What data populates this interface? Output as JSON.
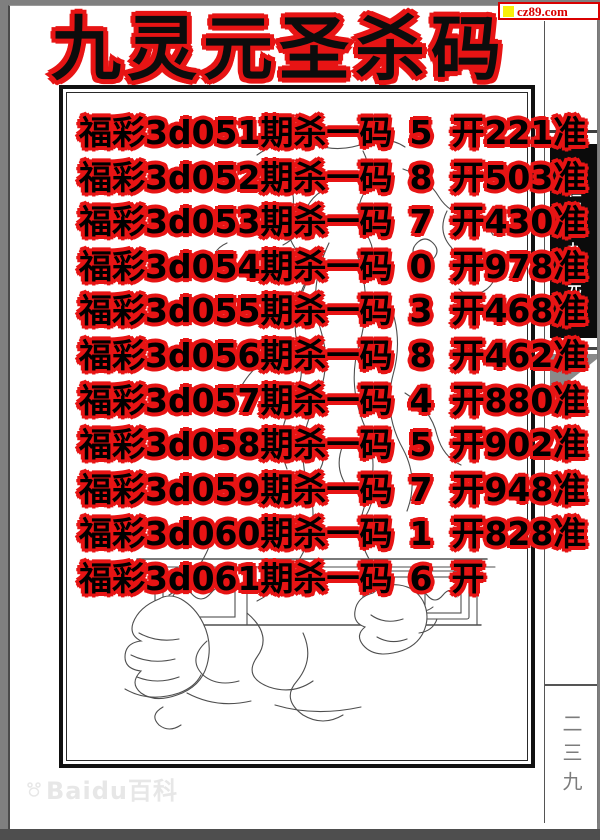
{
  "header": {
    "title": "九灵元圣杀码",
    "site": "cz89.com"
  },
  "spine": {
    "label": "盘桓洞·九灵元圣",
    "page_number": "二三九"
  },
  "footer": {
    "baidu_watermark": "Baidu百科"
  },
  "colors": {
    "outline_red": "#e71414",
    "badge_red": "#d90000",
    "badge_yellow": "#f8ef0a",
    "tab_black": "#0b0b0b",
    "frame_gray": "#7f7f7f",
    "bottom_gray": "#4e4e4e"
  },
  "rows": [
    {
      "label": "福彩3d051期杀一码",
      "kill": "5",
      "result": "开221准"
    },
    {
      "label": "福彩3d052期杀一码",
      "kill": "8",
      "result": "开503准"
    },
    {
      "label": "福彩3d053期杀一码",
      "kill": "7",
      "result": "开430准"
    },
    {
      "label": "福彩3d054期杀一码",
      "kill": "0",
      "result": "开978准"
    },
    {
      "label": "福彩3d055期杀一码",
      "kill": "3",
      "result": "开468准"
    },
    {
      "label": "福彩3d056期杀一码",
      "kill": "8",
      "result": "开462准"
    },
    {
      "label": "福彩3d057期杀一码",
      "kill": "4",
      "result": "开880准"
    },
    {
      "label": "福彩3d058期杀一码",
      "kill": "5",
      "result": "开902准"
    },
    {
      "label": "福彩3d059期杀一码",
      "kill": "7",
      "result": "开948准"
    },
    {
      "label": "福彩3d060期杀一码",
      "kill": "1",
      "result": "开828准"
    },
    {
      "label": "福彩3d061期杀一码",
      "kill": "6",
      "result": "开"
    }
  ]
}
